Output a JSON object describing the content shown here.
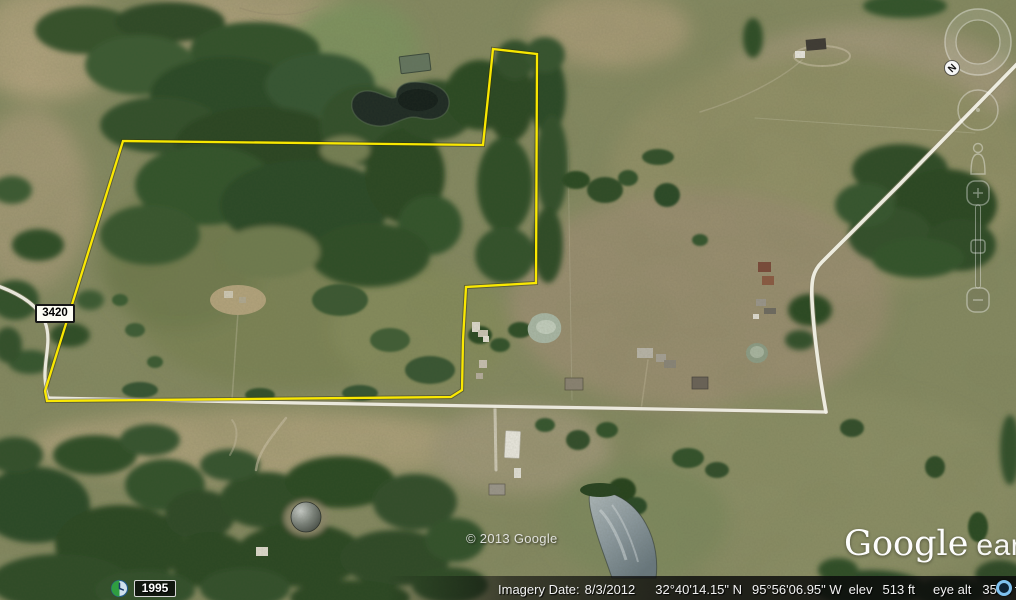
{
  "map": {
    "road_label": "3420",
    "copyright": "© 2013 Google",
    "logo": {
      "google": "Google",
      "earth": "earth"
    },
    "compass": {
      "north_label": "N"
    },
    "boundary": {
      "color": "#ffec00",
      "points": "123,141 483,145 493,49 537,54 536,283 466,287 463,340 462,390 451,397 47,401 45,391"
    },
    "roads": {
      "nw": "M -2,286 C 20,294 38,305 45,322 C 52,340 44,360 45,378 C 46,388 46,394 48,397",
      "bottom": "M 48,398 L 300,403 L 600,408 L 826,412",
      "diagonal": "M 826,412 C 822,390 814,340 812,300 C 811,280 813,271 822,262 L 900,184 L 1020,61"
    }
  },
  "time_slider": {
    "year": "1995"
  },
  "status_bar": {
    "imagery_date_label": "Imagery Date:",
    "imagery_date": "8/3/2012",
    "latitude": "32°40'14.15\" N",
    "longitude": "95°56'06.95\" W",
    "elev_label": "elev",
    "elevation": "513 ft",
    "eye_alt_label": "eye alt",
    "eye_altitude": "3574 ft"
  },
  "colors": {
    "boundary": "#ffec00",
    "road": "#f2f1e6",
    "road_casing": "#8a8468",
    "streaming_icon": "#7fc1ee",
    "status_text": "#f2f2f2"
  }
}
